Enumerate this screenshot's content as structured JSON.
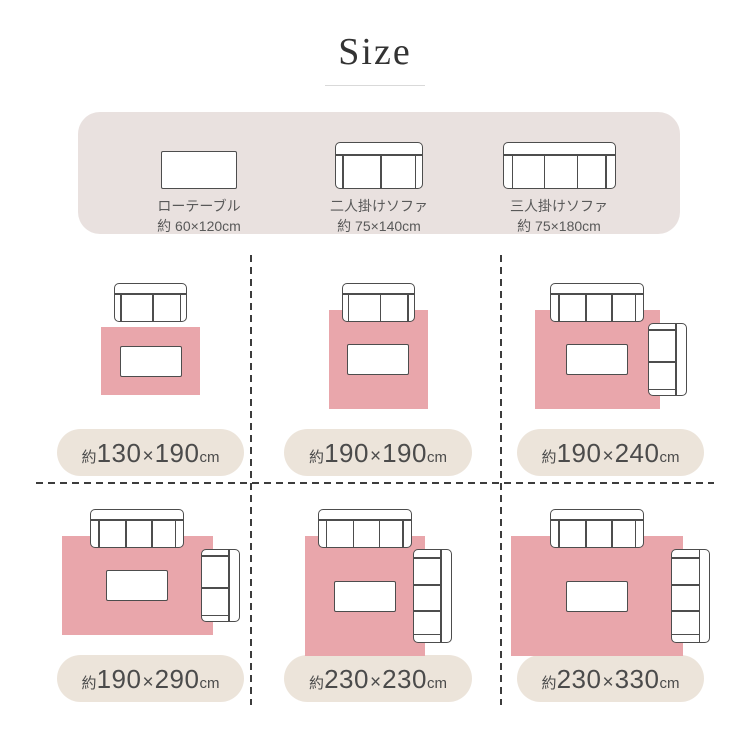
{
  "title": {
    "text": "Size"
  },
  "colors": {
    "background": "#ffffff",
    "rug_pink": "#e9a6ab",
    "legend_bg": "#e9e1df",
    "pill_bg": "#ece4da",
    "furniture_fill": "#ffffff",
    "furniture_line": "#4d4d4d",
    "text_dark": "#4b4b4b",
    "legend_text": "#595959",
    "dash_line": "#3c3c3c",
    "title_underline": "#d9d9d9"
  },
  "legend": {
    "items": [
      {
        "type": "table",
        "icon": "low-table-icon",
        "name": "ローテーブル",
        "size": "約 60×120cm"
      },
      {
        "type": "sofa-2",
        "icon": "two-seater-sofa-icon",
        "name": "二人掛けソファ",
        "size": "約 75×140cm"
      },
      {
        "type": "sofa-3",
        "icon": "three-seater-sofa-icon",
        "name": "三人掛けソファ",
        "size": "約 75×180cm"
      }
    ]
  },
  "furniture_cm": {
    "table": {
      "w": 120,
      "d": 60
    },
    "sofa_depth": 75,
    "sofa_2p_width": 140,
    "sofa_3p_width": 180
  },
  "sizes": [
    {
      "label": {
        "prefix": "約",
        "d1": "130",
        "times": "×",
        "d2": "190",
        "unit": "cm"
      },
      "rug_cm": {
        "w": 190,
        "h": 130
      },
      "top_sofa_seats": 2,
      "side_sofa_seats": null
    },
    {
      "label": {
        "prefix": "約",
        "d1": "190",
        "times": "×",
        "d2": "190",
        "unit": "cm"
      },
      "rug_cm": {
        "w": 190,
        "h": 190
      },
      "top_sofa_seats": 2,
      "side_sofa_seats": null
    },
    {
      "label": {
        "prefix": "約",
        "d1": "190",
        "times": "×",
        "d2": "240",
        "unit": "cm"
      },
      "rug_cm": {
        "w": 240,
        "h": 190
      },
      "top_sofa_seats": 3,
      "side_sofa_seats": 2
    },
    {
      "label": {
        "prefix": "約",
        "d1": "190",
        "times": "×",
        "d2": "290",
        "unit": "cm"
      },
      "rug_cm": {
        "w": 290,
        "h": 190
      },
      "top_sofa_seats": 3,
      "side_sofa_seats": 2
    },
    {
      "label": {
        "prefix": "約",
        "d1": "230",
        "times": "×",
        "d2": "230",
        "unit": "cm"
      },
      "rug_cm": {
        "w": 230,
        "h": 230
      },
      "top_sofa_seats": 3,
      "side_sofa_seats": 3
    },
    {
      "label": {
        "prefix": "約",
        "d1": "230",
        "times": "×",
        "d2": "330",
        "unit": "cm"
      },
      "rug_cm": {
        "w": 330,
        "h": 230
      },
      "top_sofa_seats": 3,
      "side_sofa_seats": 3
    }
  ]
}
